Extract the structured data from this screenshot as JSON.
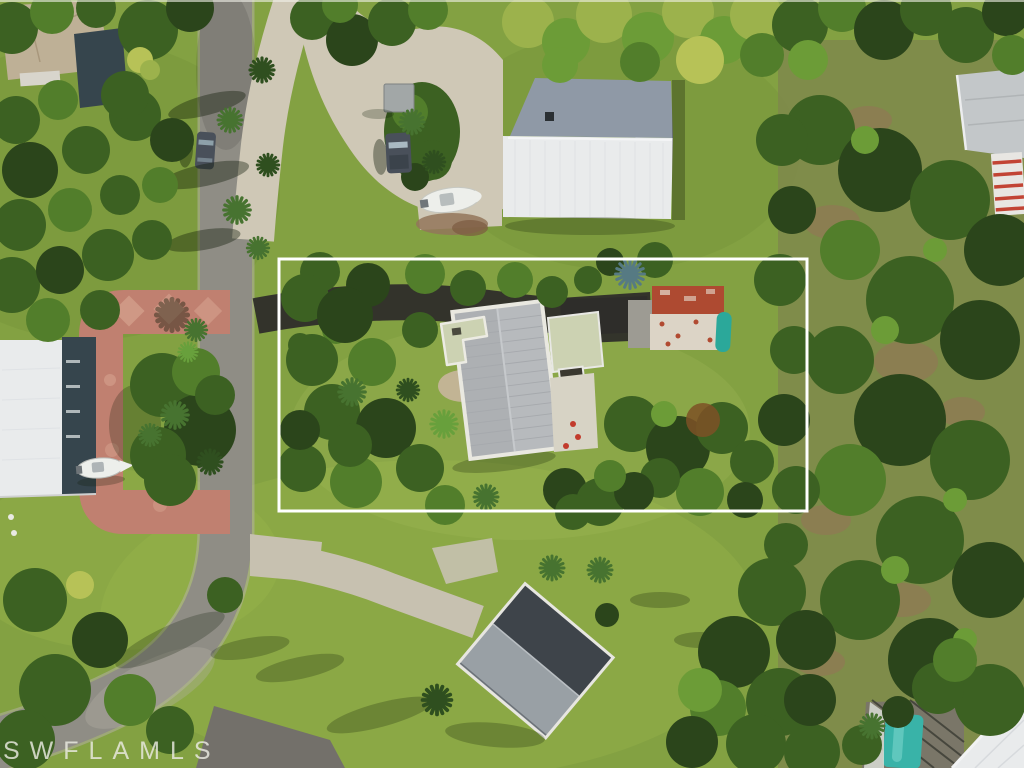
{
  "watermark": {
    "text": "SWFLAMLS"
  },
  "annotation": {
    "boundary_label": "highlighted-parcel-boundary"
  },
  "colors": {
    "lawn": "#83a142",
    "scrub_olive": "#7e894b",
    "road_asphalt": "#8f8d85",
    "road_shoulder": "#b4b0a4",
    "concrete": "#cfc8b6",
    "concrete_light": "#c7c1b0",
    "paver_pink": "#c08070",
    "paver_pink_light": "#d5a28e",
    "asphalt_dark": "#2e2d2a",
    "neighbor_drive_gray": "#73706a",
    "roof_white": "#e9ebec",
    "roof_shadow_blue": "#8f99a6",
    "roof_gray": "#b7babd",
    "roof_gray_light": "#99a0a5",
    "roof_dark": "#3e444a",
    "roof_tan": "#beb096",
    "roof_pale_green": "#ccd2b2",
    "enclosure_slate": "#36454d",
    "patio_red": "#ae4a31",
    "patio_white": "#dcd4c6",
    "kayak_teal": "#2ba89a",
    "pool_teal": "#39b3a8",
    "boat_white": "#edefeb",
    "vehicle_dark": "#49505a",
    "boundary": "#ffffff",
    "watermark_white": "#ebebe2"
  },
  "scene": {
    "objects": [
      "aerial-photo",
      "main-road",
      "concrete-driveway",
      "paver-circular-driveway",
      "asphalt-driveway",
      "rear-driveway",
      "featured-house",
      "outbuilding",
      "left-house",
      "top-left-house",
      "bottom-house",
      "top-right-house",
      "patio",
      "kayak",
      "pool",
      "pool-screen",
      "boat",
      "truck",
      "car",
      "pavilion",
      "parcel-boundary",
      "mls-watermark"
    ]
  }
}
